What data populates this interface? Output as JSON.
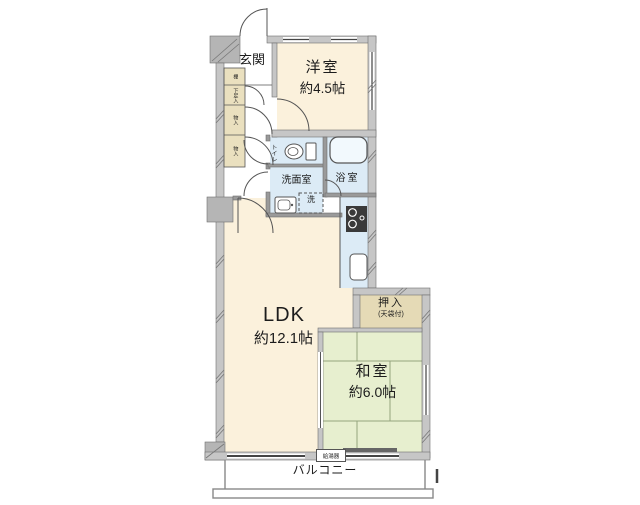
{
  "rooms": {
    "entrance": {
      "label": "玄関"
    },
    "western_room": {
      "label": "洋室",
      "size": "約4.5帖"
    },
    "toilet": {
      "label": "トイレ"
    },
    "bath": {
      "label": "浴室"
    },
    "washroom": {
      "label": "洗面室",
      "washer": "洗"
    },
    "ldk": {
      "label": "LDK",
      "size": "約12.1帖"
    },
    "oshiire": {
      "label": "押入",
      "note": "(天袋付)"
    },
    "japanese_room": {
      "label": "和室",
      "size": "約6.0帖"
    },
    "balcony": {
      "label": "バルコニー",
      "water_heater": "給湯器"
    }
  },
  "storage": {
    "shelf": "棚",
    "shoe_box": "下足入",
    "closet_upper": "物入",
    "closet_lower": "物入"
  },
  "colors": {
    "floor_wood": "#fbf1dc",
    "tatami_green": "#e7efcf",
    "water_blue": "#dcebf6",
    "closet_tan": "#eae0bf",
    "oshiire_tan": "#e5dab6",
    "wall_gray": "#c6c6c6",
    "wall_dark": "#b5b5b5",
    "line_dark": "#555555"
  }
}
